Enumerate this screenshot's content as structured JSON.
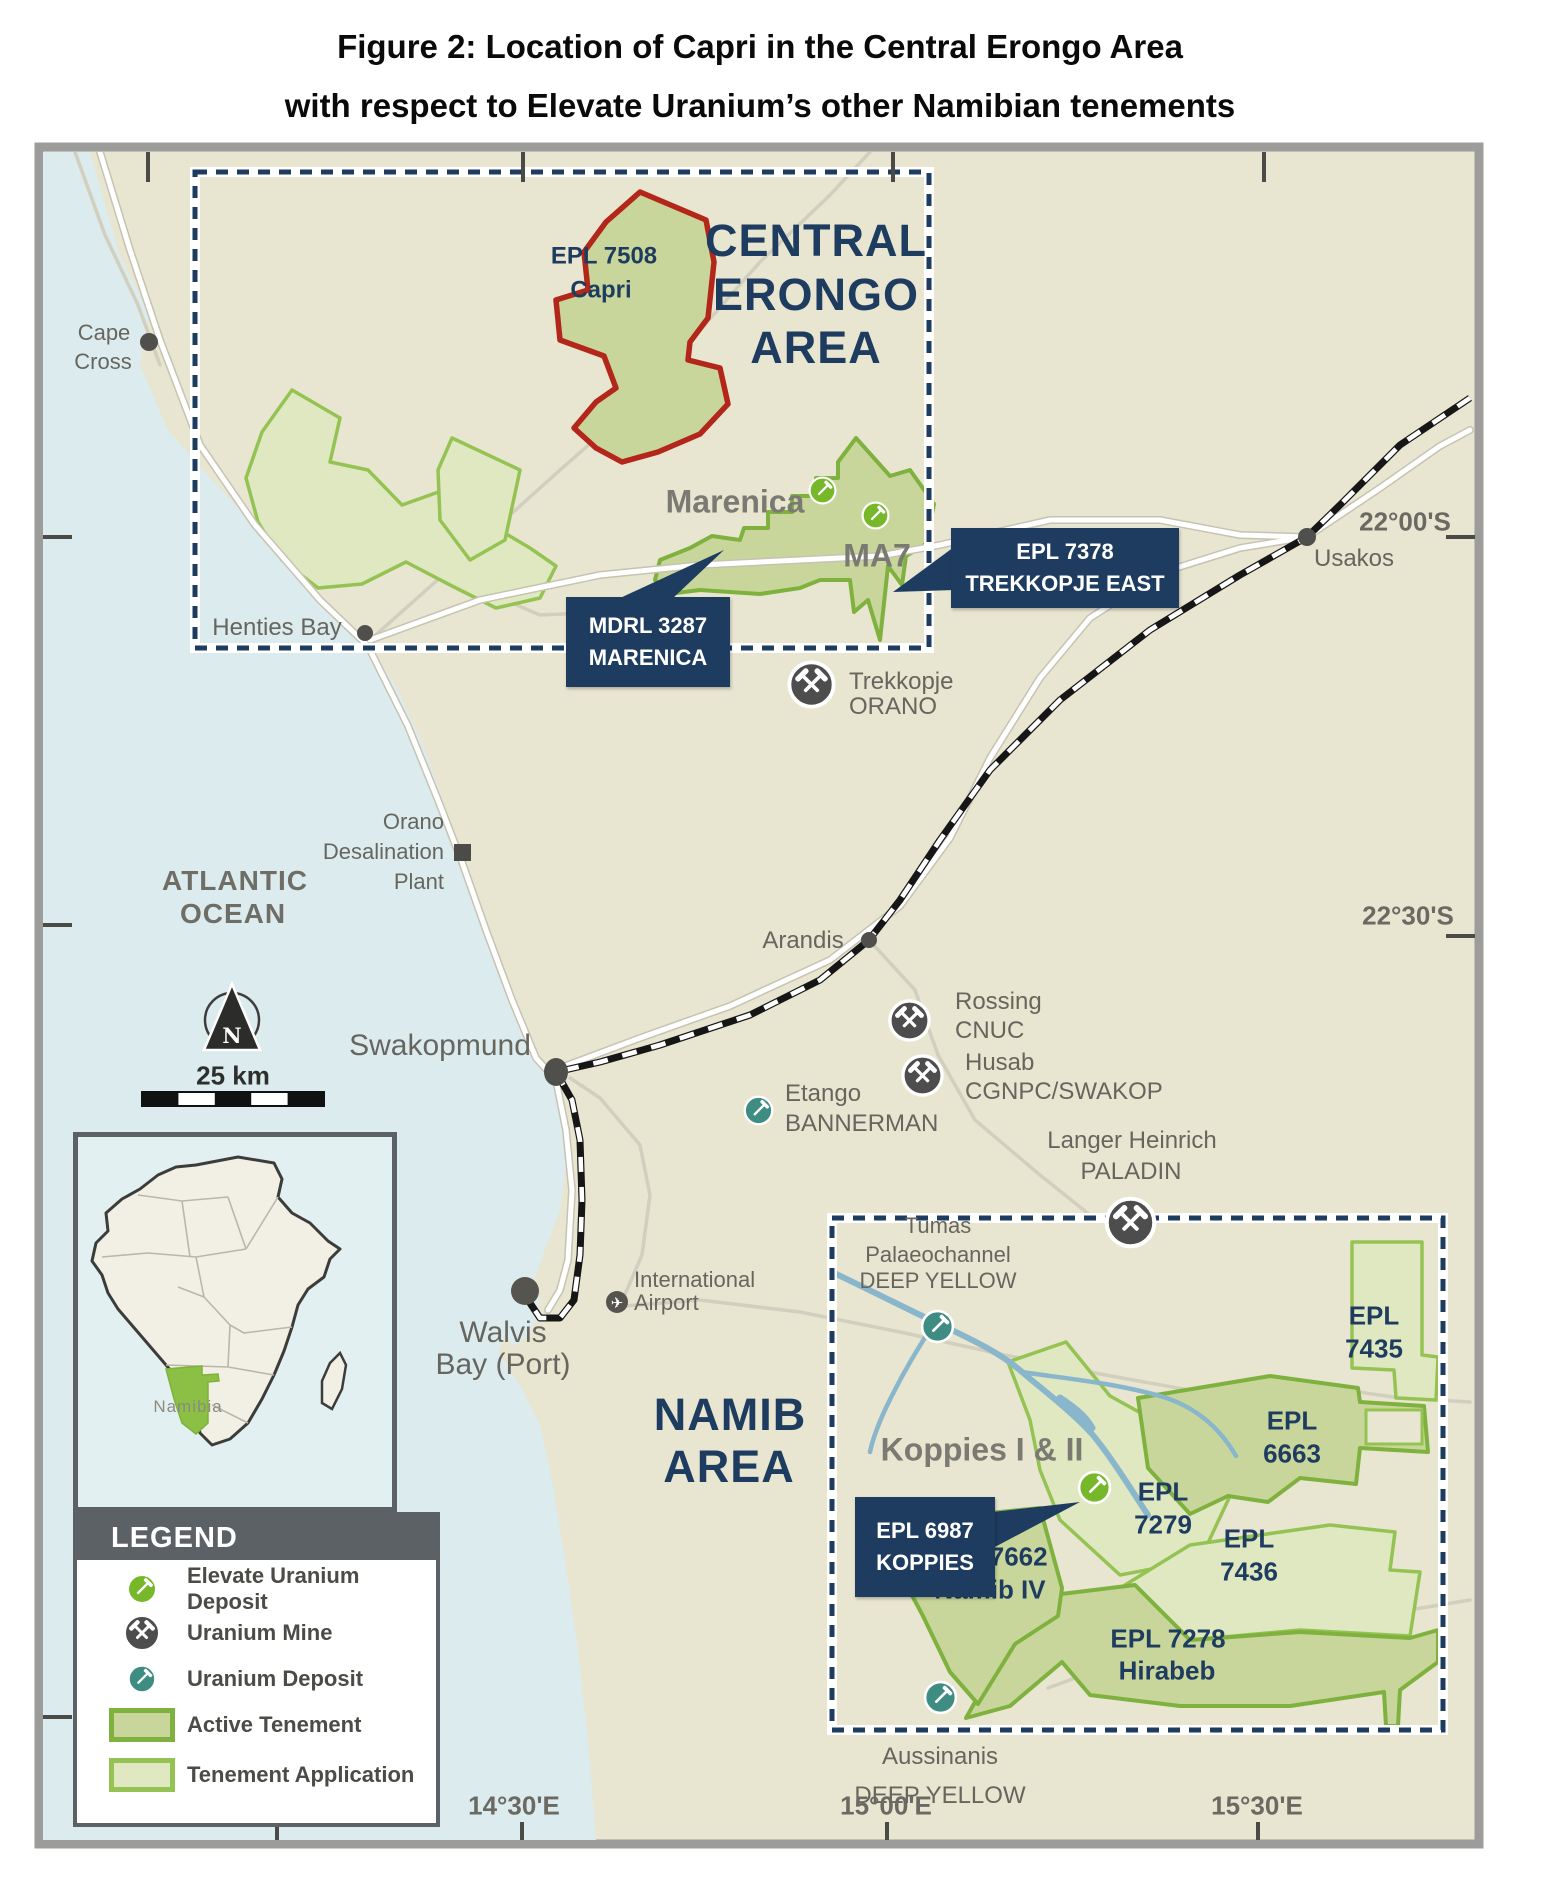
{
  "title": {
    "line1": "Figure 2: Location of Capri in the Central Erongo Area",
    "line2": "with respect to Elevate Uranium’s other Namibian tenements"
  },
  "region_labels": {
    "central_erongo": {
      "line1": "CENTRAL",
      "line2": "ERONGO",
      "line3": "AREA"
    },
    "namib": {
      "line1": "NAMIB",
      "line2": "AREA"
    },
    "atlantic_ocean": {
      "line1": "ATLANTIC",
      "line2": "OCEAN"
    }
  },
  "places": {
    "cape_cross": {
      "line1": "Cape",
      "line2": "Cross"
    },
    "henties_bay": {
      "label": "Henties Bay"
    },
    "swakopmund": {
      "label": "Swakopmund"
    },
    "walvis_bay": {
      "line1": "Walvis",
      "line2": "Bay (Port)"
    },
    "usakos": {
      "label": "Usakos"
    },
    "arandis": {
      "label": "Arandis"
    },
    "airport": {
      "line1": "International",
      "line2": "Airport"
    },
    "desalination_plant": {
      "line1": "Orano",
      "line2": "Desalination",
      "line3": "Plant"
    }
  },
  "mines": {
    "trekkopje": {
      "name": "Trekkopje",
      "operator": "ORANO"
    },
    "rossing": {
      "name": "Rossing",
      "operator": "CNUC"
    },
    "husab": {
      "name": "Husab",
      "operator": "CGNPC/SWAKOP"
    },
    "langer_heinrich": {
      "name": "Langer Heinrich",
      "operator": "PALADIN"
    }
  },
  "deposits": {
    "marenica": {
      "name": "Marenica"
    },
    "ma7": {
      "name": "MA7"
    },
    "etango": {
      "name": "Etango",
      "operator": "BANNERMAN"
    },
    "tumas": {
      "line1": "Tumas",
      "line2": "Palaeochannel",
      "operator": "DEEP YELLOW"
    },
    "koppies": {
      "name": "Koppies I & II"
    },
    "aussinanis": {
      "name": "Aussinanis",
      "operator": "DEEP YELLOW"
    }
  },
  "tenements": {
    "capri": {
      "line1": "EPL 7508",
      "line2": "Capri"
    },
    "epl_7435": {
      "line1": "EPL",
      "line2": "7435"
    },
    "epl_6663": {
      "line1": "EPL",
      "line2": "6663"
    },
    "epl_7279": {
      "line1": "EPL",
      "line2": "7279"
    },
    "epl_7436": {
      "line1": "EPL",
      "line2": "7436"
    },
    "epl_7662": {
      "line1": "EPL 7662",
      "line2": "Namib IV"
    },
    "epl_7278": {
      "line1": "EPL 7278",
      "line2": "Hirabeb"
    }
  },
  "callouts": {
    "marenica": {
      "line1": "MDRL 3287",
      "line2": "MARENICA"
    },
    "trekkopje_east": {
      "line1": "EPL 7378",
      "line2": "TREKKOPJE EAST"
    },
    "koppies": {
      "line1": "EPL 6987",
      "line2": "KOPPIES"
    }
  },
  "graticule": {
    "lat_22_00": "22°00'S",
    "lat_22_30": "22°30'S",
    "lon_14_30": "14°30'E",
    "lon_15_00": "15°00'E",
    "lon_15_30": "15°30'E"
  },
  "legend": {
    "header": "LEGEND",
    "items": [
      {
        "icon": "elevate-uranium-deposit-icon",
        "label": "Elevate Uranium Deposit"
      },
      {
        "icon": "uranium-mine-icon",
        "label": "Uranium Mine"
      },
      {
        "icon": "uranium-deposit-icon",
        "label": "Uranium Deposit"
      },
      {
        "icon": "active-tenement-swatch",
        "label": "Active Tenement"
      },
      {
        "icon": "tenement-application-swatch",
        "label": "Tenement Application"
      }
    ]
  },
  "inset": {
    "country_label": "Namibia"
  },
  "scale_bar": {
    "label": "25 km"
  },
  "compass": {
    "label": "N"
  },
  "colors": {
    "navy": "#1e3c5f",
    "land": "#e8e5d0",
    "ocean": "#dcebee",
    "active_tenement_fill": "#c9d69b",
    "active_tenement_stroke": "#7fb13f",
    "application_fill": "#e0e8c2",
    "application_stroke": "#95c353",
    "capri_outline": "#b3261a",
    "elevate_deposit_green": "#76b82a",
    "uranium_deposit_teal": "#3e8c82",
    "uranium_mine_gray": "#4d4d4d",
    "river_blue": "#8ab6cb"
  }
}
